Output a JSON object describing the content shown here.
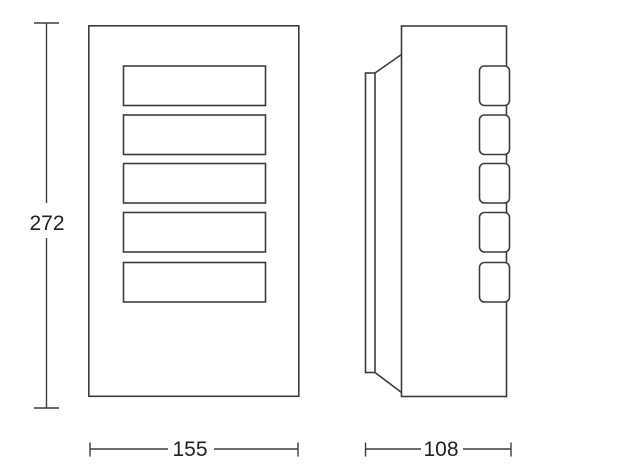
{
  "drawing": {
    "colors": {
      "background": "#ffffff",
      "line": "#3d3d3d",
      "label": "#222222"
    },
    "dimensions": {
      "height": "272",
      "width": "155",
      "depth": "108"
    }
  }
}
